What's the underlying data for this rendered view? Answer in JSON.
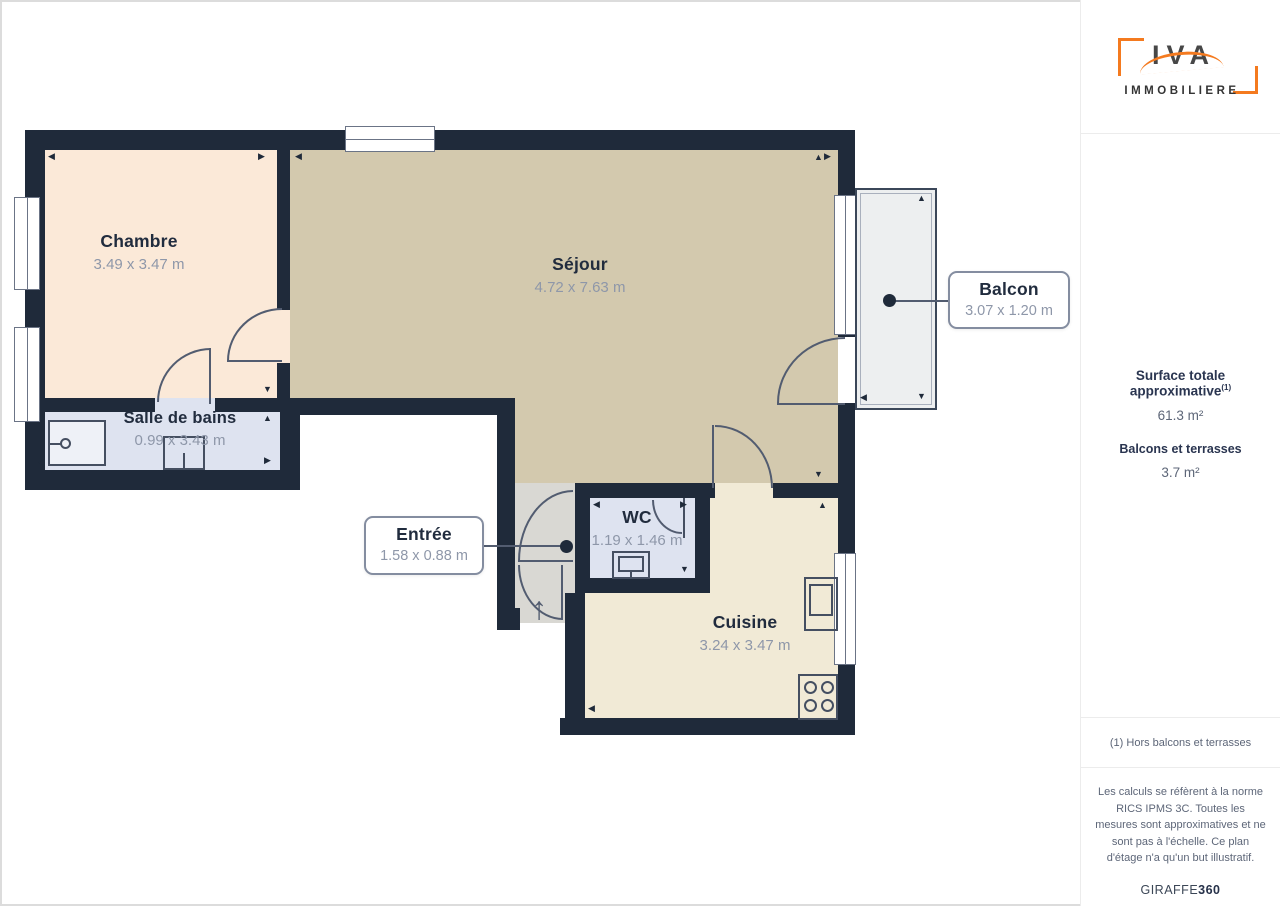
{
  "sidebar": {
    "logo": {
      "brand": "IVA",
      "subtitle": "IMMOBILIERE"
    },
    "surface_title": "Surface totale approximative",
    "surface_sup": "(1)",
    "surface_value": "61.3 m²",
    "balcony_title": "Balcons et terrasses",
    "balcony_value": "3.7 m²",
    "footnote": "(1) Hors balcons et terrasses",
    "legal": "Les calculs se réfèrent à la norme RICS IPMS 3C. Toutes les mesures sont approximatives et ne sont pas à l'échelle. Ce plan d'étage n'a qu'un but illustratif.",
    "brand_footer_regular": "GIRAFFE",
    "brand_footer_bold": "360"
  },
  "plan": {
    "rooms": [
      {
        "id": "chambre",
        "name": "Chambre",
        "dims": "3.49 x 3.47 m"
      },
      {
        "id": "sejour",
        "name": "Séjour",
        "dims": "4.72 x 7.63 m"
      },
      {
        "id": "salle_de_bains",
        "name": "Salle de bains",
        "dims": "0.99 x 3.43 m"
      },
      {
        "id": "wc",
        "name": "WC",
        "dims": "1.19 x 1.46 m"
      },
      {
        "id": "cuisine",
        "name": "Cuisine",
        "dims": "3.24 x 3.47 m"
      },
      {
        "id": "entree",
        "name": "Entrée",
        "dims": "1.58 x 0.88 m"
      },
      {
        "id": "balcon",
        "name": "Balcon",
        "dims": "3.07 x 1.20 m"
      }
    ],
    "entrance_arrow": "↑",
    "colors": {
      "wall": "#1f2a3a",
      "chambre_floor": "#fbe9d8",
      "sejour_floor": "#d3c9ae",
      "bath_floor": "#dee3f0",
      "entree_floor": "#d9d8d3",
      "cuisine_floor": "#f1ead6",
      "balcony_floor": "#edeff0",
      "accent_orange": "#f47a1f",
      "title_text": "#212c3e",
      "dims_text": "#8e97a9"
    }
  }
}
